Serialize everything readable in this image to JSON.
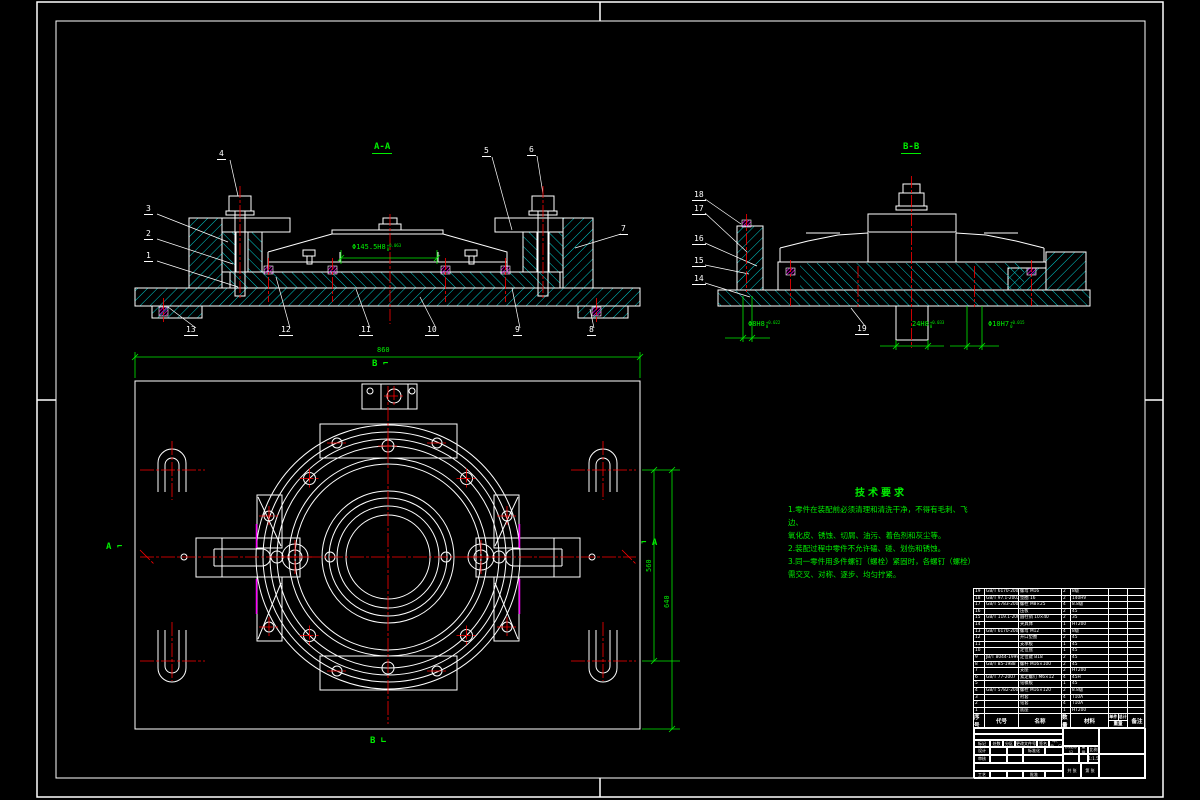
{
  "section_aa": {
    "label": "A-A",
    "balloons": [
      "1",
      "2",
      "3",
      "4",
      "5",
      "6",
      "7",
      "8",
      "9",
      "10",
      "11",
      "12",
      "13"
    ],
    "dim_bore": {
      "text": "Φ145.5H8",
      "tol_up": "+0.063",
      "tol_dn": "0"
    }
  },
  "section_bb": {
    "label": "B-B",
    "balloons": [
      "14",
      "15",
      "16",
      "17",
      "18",
      "19"
    ],
    "dims": [
      {
        "text": "Φ8H8",
        "tol_up": "+0.022",
        "tol_dn": "0"
      },
      {
        "text": "24H8",
        "tol_up": "+0.033",
        "tol_dn": "0"
      },
      {
        "text": "Φ10H7",
        "tol_up": "+0.015",
        "tol_dn": "0"
      }
    ]
  },
  "plan": {
    "dim_width": "860",
    "dim_right_inner": "560",
    "dim_right_outer": "640",
    "marker_b_top": "B ⌐",
    "marker_b_bottom": "B ∟",
    "marker_a_left": "A ⌐",
    "marker_a_right": "⌐ A"
  },
  "tech_notes": {
    "title": "技术要求",
    "lines": [
      "1.零件在装配前必须清理和清洗干净，不得有毛刺、飞边、",
      "氧化皮、锈蚀、切屑、油污、着色剂和灰尘等。",
      "2.装配过程中零件不允许磕、碰、划伤和锈蚀。",
      "3.同一零件用多件螺钉（螺栓）紧固时，各螺钉（螺栓）",
      "需交叉、对称、逐步、均匀拧紧。"
    ]
  },
  "bom": {
    "headers": [
      "序号",
      "代号",
      "名称",
      "数量",
      "材料",
      "重量",
      "备注"
    ],
    "weight_sub": [
      "单件",
      "总计"
    ],
    "rows": [
      [
        "19",
        "GB/T 6170-2000",
        "螺母 M16",
        "2",
        "8级",
        "",
        ""
      ],
      [
        "18",
        "GB/T 97.1-2002",
        "垫圈 16",
        "2",
        "140HV",
        "",
        ""
      ],
      [
        "17",
        "GB/T 5783-2000",
        "螺栓 M8×25",
        "4",
        "8.8级",
        "",
        ""
      ],
      [
        "16",
        "",
        "压板",
        "2",
        "45",
        "",
        ""
      ],
      [
        "15",
        "GB/T 119.1-2000",
        "圆柱销 10×40",
        "2",
        "35",
        "",
        ""
      ],
      [
        "14",
        "",
        "夹具体",
        "1",
        "HT200",
        "",
        ""
      ],
      [
        "13",
        "GB/T 6170-2000",
        "螺母 M12",
        "4",
        "8级",
        "",
        ""
      ],
      [
        "12",
        "",
        "开口垫圈",
        "2",
        "45",
        "",
        ""
      ],
      [
        "11",
        "",
        "支承板",
        "1",
        "45",
        "",
        ""
      ],
      [
        "10",
        "",
        "定位盘",
        "1",
        "45",
        "",
        ""
      ],
      [
        "9",
        "JB/T 8044-1999",
        "定位键 B18",
        "2",
        "45",
        "",
        ""
      ],
      [
        "8",
        "GB/T 85-1988",
        "螺杆 M16×100",
        "2",
        "45",
        "",
        ""
      ],
      [
        "7",
        "",
        "支座",
        "2",
        "HT200",
        "",
        ""
      ],
      [
        "6",
        "GB/T 77-2007",
        "紧定螺钉 M6×12",
        "4",
        "45H",
        "",
        ""
      ],
      [
        "5",
        "",
        "钻模板",
        "1",
        "45",
        "",
        ""
      ],
      [
        "4",
        "GB/T 5782-2000",
        "螺栓 M16×120",
        "2",
        "8.8级",
        "",
        ""
      ],
      [
        "3",
        "",
        "衬套",
        "4",
        "T10A",
        "",
        ""
      ],
      [
        "2",
        "",
        "钻套",
        "4",
        "T10A",
        "",
        ""
      ],
      [
        "1",
        "",
        "底座",
        "1",
        "HT200",
        "",
        ""
      ]
    ]
  },
  "title_block": {
    "mark": "标记",
    "count": "处数",
    "zone": "分区",
    "doc": "更改文件号",
    "sign": "签名",
    "date": "年、月、日",
    "design": "设计",
    "check": "审核",
    "process": "工艺",
    "standard": "标准化",
    "approve": "批准",
    "stage": "阶段标记",
    "weight": "重量",
    "scale": "比例",
    "scale_value": "1:1.5",
    "sheets": "共 张",
    "page": "第 张"
  }
}
